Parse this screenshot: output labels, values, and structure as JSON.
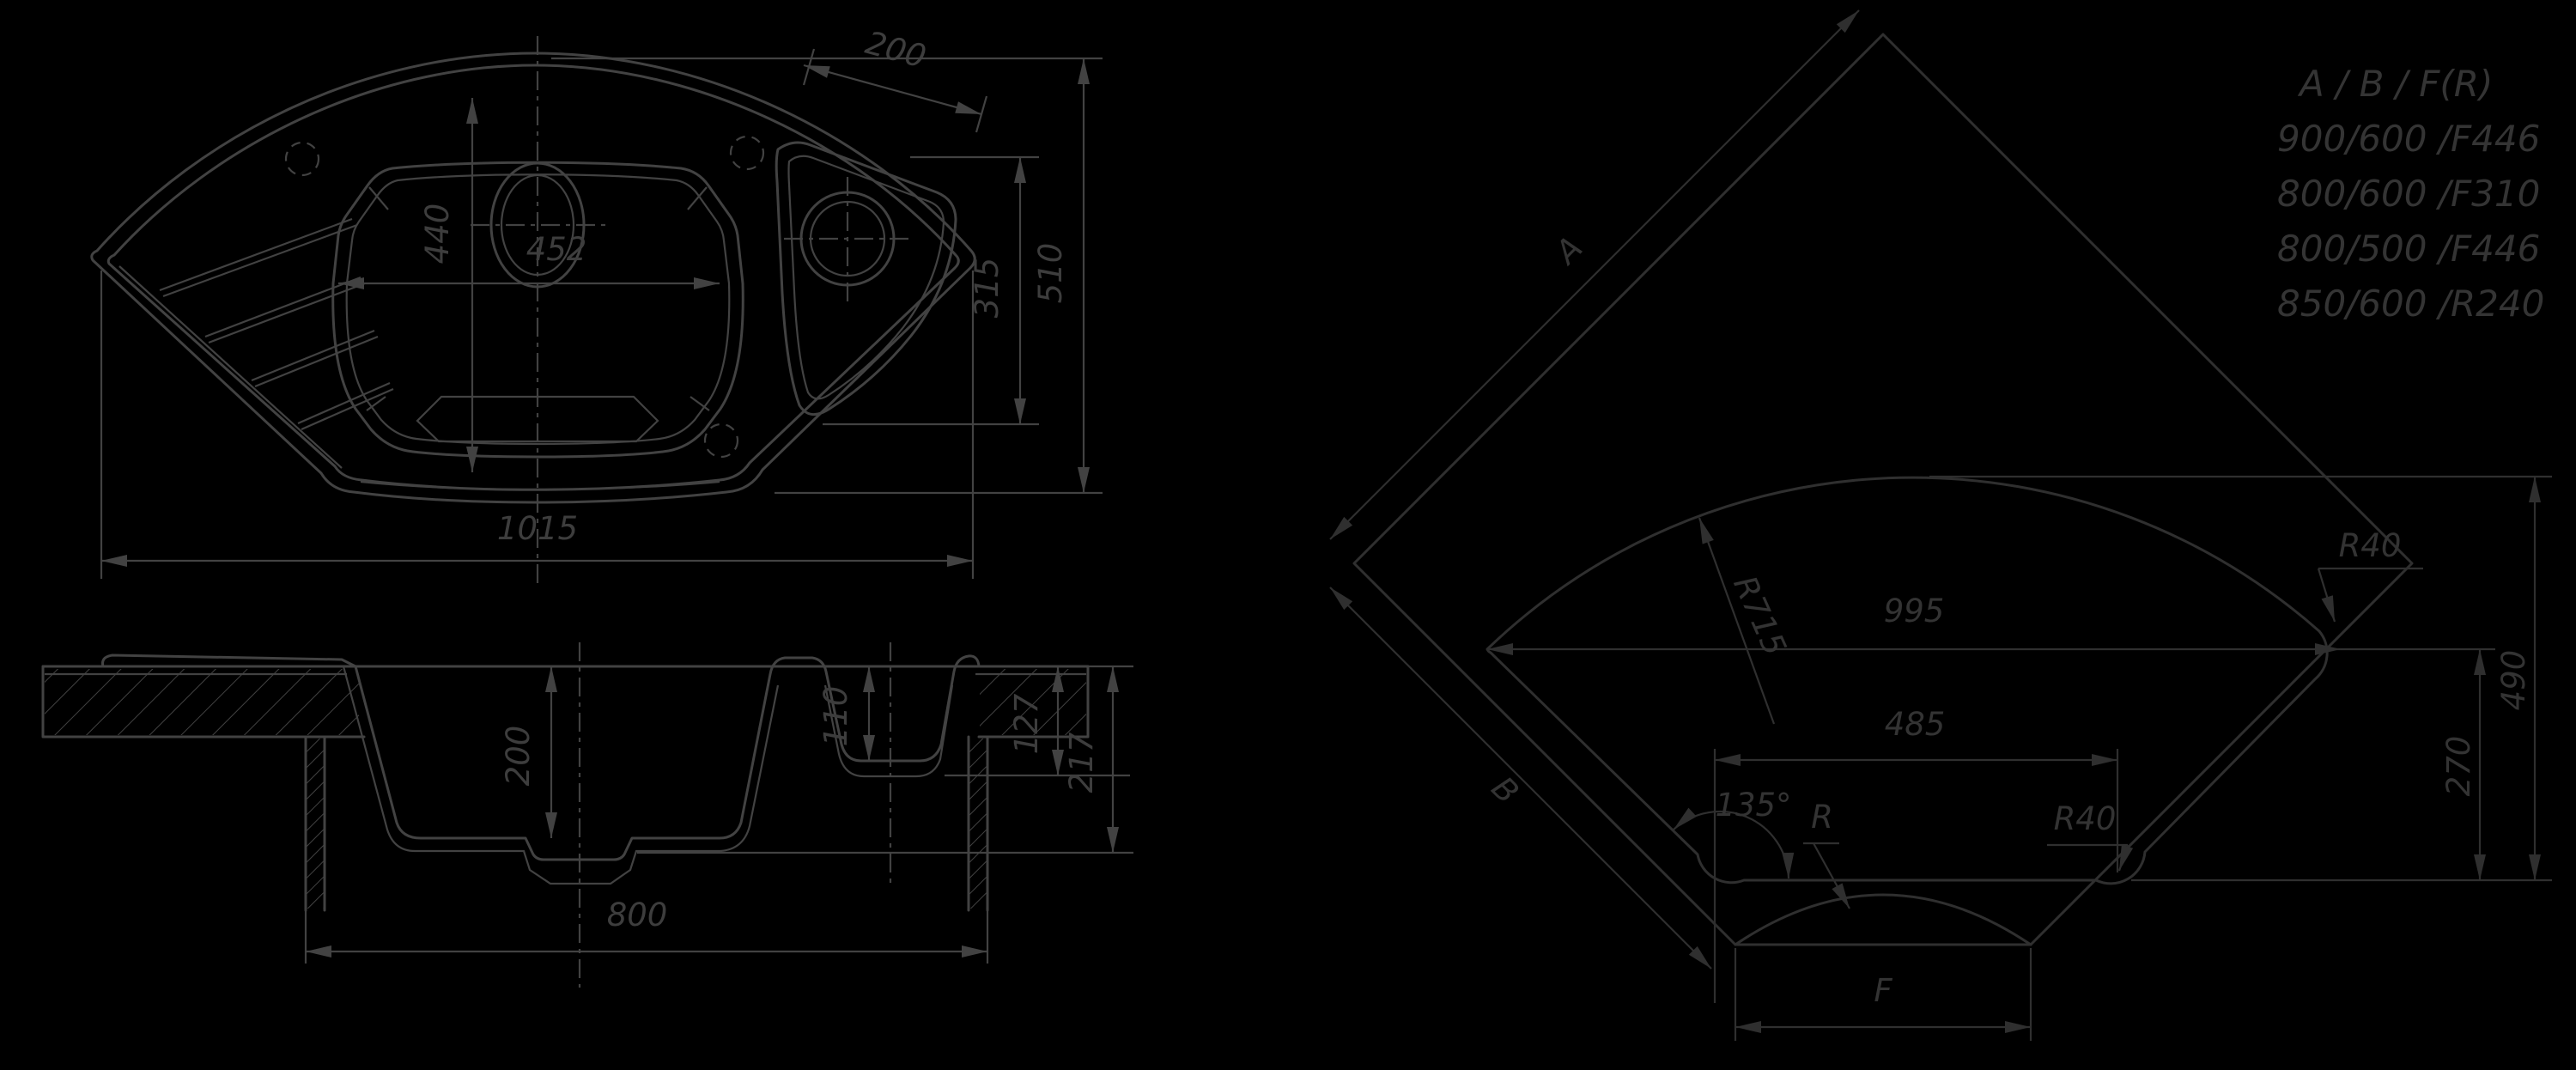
{
  "colors": {
    "background": "#000000",
    "linework_left_views": "#424242",
    "linework_corner_view": "#2f2f2f",
    "text": "#3a3a3a"
  },
  "plan_view": {
    "dim_small_bowl_edge": "200",
    "dim_bowl_length": "440",
    "dim_bowl_width": "452",
    "dim_small_bowl_span": "315",
    "dim_overall_depth": "510",
    "dim_overall_width": "1015"
  },
  "section_view": {
    "dim_main_bowl_depth": "200",
    "dim_small_bowl_depth": "110",
    "dim_under_edge": "127",
    "dim_under_bowl": "217",
    "dim_cabinet_width": "800"
  },
  "corner_view": {
    "edge_a": "A",
    "edge_b": "B",
    "radius_back_arc": "R715",
    "dim_width": "995",
    "dim_front_edge": "485",
    "dim_front_offset": "270",
    "dim_height": "490",
    "angle_front": "135°",
    "radius_front_label": "R",
    "radius_corner_top": "R40",
    "radius_corner_front": "R40",
    "dim_front_width": "F"
  },
  "legend": {
    "header": "A  /  B  /  F(R)",
    "rows": [
      "900/600 /F446",
      "800/600 /F310",
      "800/500 /F446",
      "850/600 /R240"
    ]
  }
}
